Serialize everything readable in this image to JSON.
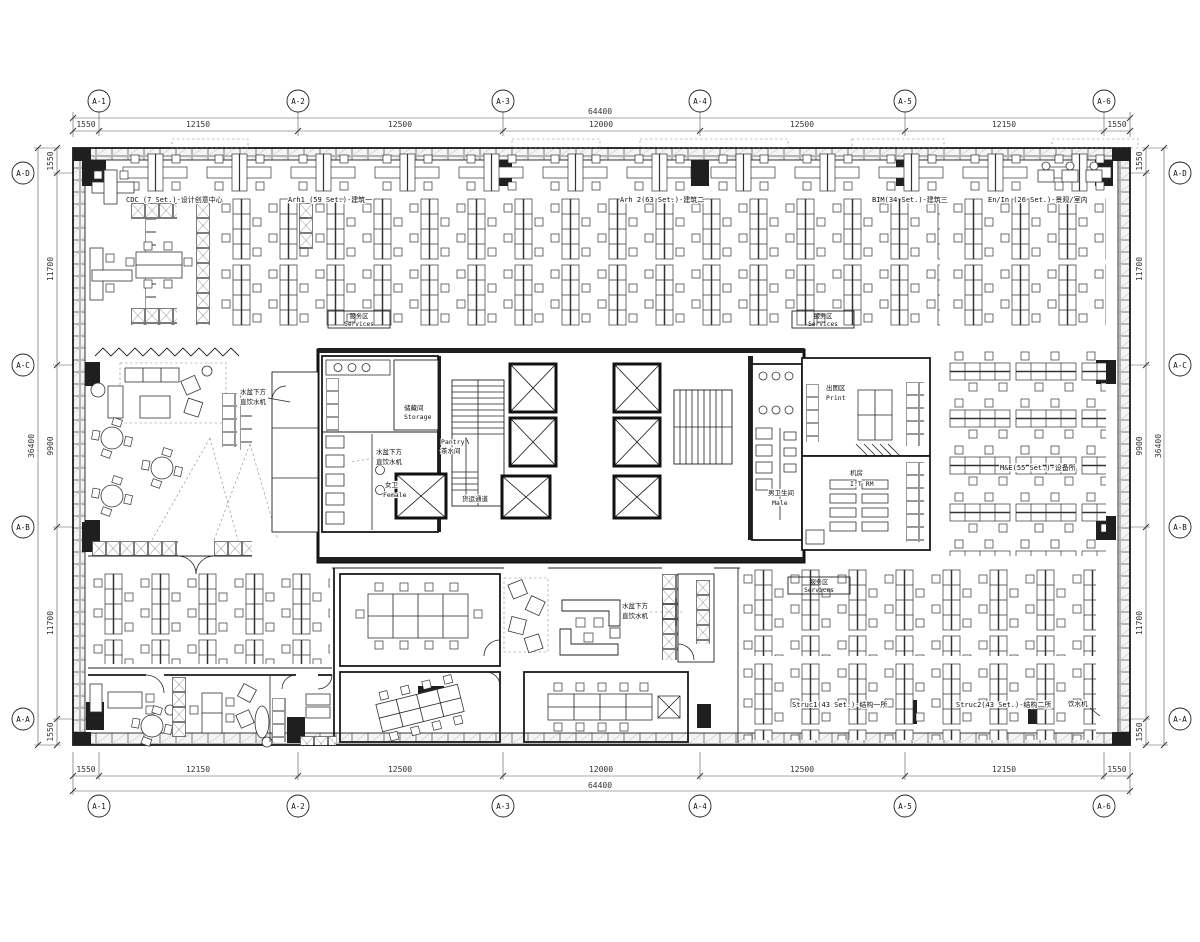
{
  "drawing": {
    "grid": {
      "cols": [
        "A-1",
        "A-2",
        "A-3",
        "A-4",
        "A-5",
        "A-6"
      ],
      "col_dims": [
        "1550",
        "12150",
        "12500",
        "12000",
        "12500",
        "12150",
        "1550"
      ],
      "col_total": "64400",
      "rows": [
        "A-D",
        "A-C",
        "A-B",
        "A-A"
      ],
      "row_dims": [
        "1550",
        "11700",
        "9900",
        "11700",
        "1550"
      ],
      "row_total": "36400"
    },
    "zones": {
      "cdc": "CDC (7 Set.)-设计创意中心",
      "arh1": "Arh1 (59 Set.)-建筑一",
      "arh2": "Arh 2(63 Set.)-建筑二",
      "bim3": "BIM(34 Set.)-建筑三",
      "enin": "En/In (26 Set.)-景观/室内",
      "me": "M&E(55 Set.)-设备所",
      "struc1": "Struc1(43 Set.)-结构一所",
      "struc2": "Struc2(43 Set.)-结构二所"
    },
    "rooms": {
      "services_cn": "服务区",
      "services_en": "Services",
      "storage_cn": "储藏间",
      "storage_en": "Storage",
      "pantry_en": "Pantry",
      "pantry_cn": "茶水间",
      "female_cn": "女卫",
      "female_en": "Female",
      "male_cn": "男卫生间",
      "male_en": "Male",
      "freight": "货运通道",
      "print_cn": "出图区",
      "print_en": "Print",
      "it_cn": "机房",
      "it_en": "I.T RM"
    },
    "notes": {
      "sink_water_l1": "水盆下方",
      "sink_water_l2": "直饮水机",
      "water_dispenser": "饮水机"
    }
  }
}
